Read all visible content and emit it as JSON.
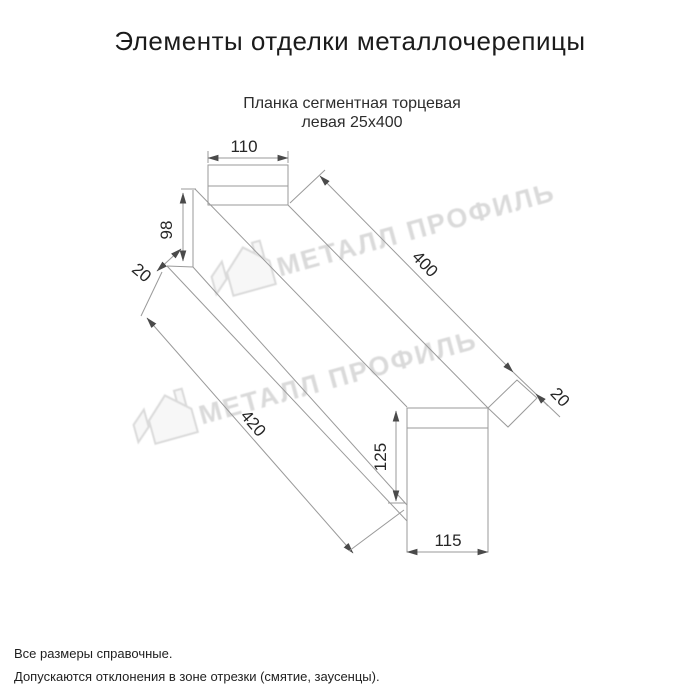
{
  "title": "Элементы отделки металлочерепицы",
  "subtitle": {
    "line1": "Планка сегментная торцевая",
    "line2": "левая 25х400"
  },
  "dimensions": {
    "top_width": "110",
    "near_height": "98",
    "near_flange": "20",
    "length_top": "400",
    "far_flange": "20",
    "length_bottom": "420",
    "end_height": "125",
    "end_width": "115"
  },
  "watermark": {
    "text": "МЕТАЛЛ ПРОФИЛЬ"
  },
  "notes": {
    "line1": "Все размеры справочные.",
    "line2": "Допускаются отклонения в зоне отрезки (смятие, заусенцы)."
  },
  "colors": {
    "line": "#9a9a9a",
    "arrow": "#4a4a4a",
    "text": "#262626",
    "watermark": "#dadada"
  }
}
